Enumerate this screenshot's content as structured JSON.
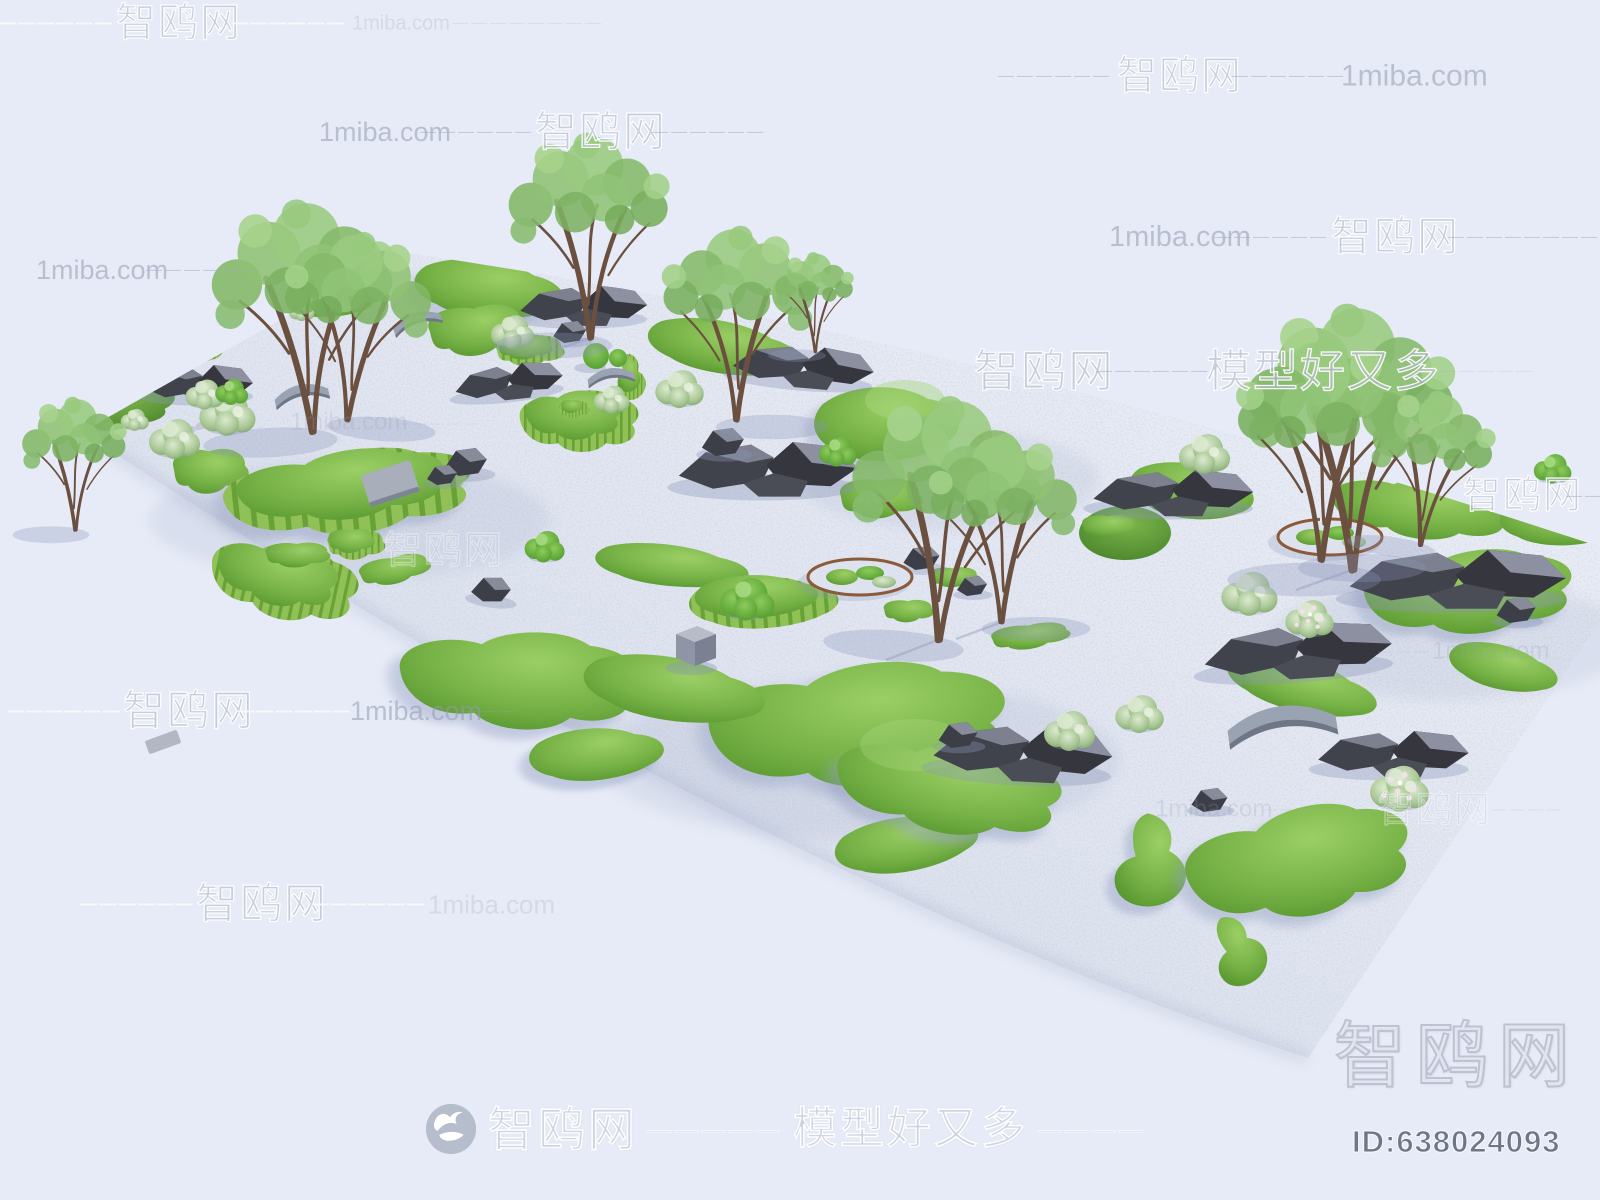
{
  "page": {
    "width": 1600,
    "height": 1200,
    "background": "#e7ebf7",
    "kind": "3D model marketplace product render"
  },
  "image": {
    "description": "Aerial 3D render of a rectangular zen landscape garden: white gravel base with organic green grass mounds, stepped turf terraces, dark rockeries, sage shrubs, slender multi-stem trees, two corten-edged circular planters, small grey arched bridges, a cube seat and topiary balls."
  },
  "palette": {
    "background": "#e7ebf7",
    "gravel": "#dde2ee",
    "gravel_shadow": "#98a3c0",
    "grass_light": "#97cc62",
    "grass_dark": "#4d8a2a",
    "terrace_stripe": "#68a136",
    "rock_dark": "#35363e",
    "rock_light": "#8c90a0",
    "bridge_grey": "#9aa3b2",
    "corten_rim": "#8a5a3a",
    "tree_trunk": "#6b5040",
    "tree_foliage": "#8fc274",
    "watermark_grey": "#929cb0"
  },
  "watermarks": {
    "site_name": "智鸥网",
    "site_url": "1miba.com",
    "slogan": "模型好又多",
    "rows": [
      {
        "y": 24,
        "segments": [
          {
            "t": "——————",
            "kind": "dash",
            "light": true,
            "x": 0,
            "fs": 16
          },
          {
            "t": "智鸥网",
            "kind": "zh",
            "x": 116,
            "fs": 40
          },
          {
            "t": "——————",
            "kind": "dash",
            "light": true,
            "x": 232,
            "fs": 16
          },
          {
            "t": "1miba.com",
            "kind": "url",
            "faint": true,
            "x": 352,
            "fs": 20
          },
          {
            "t": "————————",
            "kind": "dash",
            "faint": true,
            "x": 452,
            "fs": 16
          }
        ]
      },
      {
        "y": 77,
        "segments": [
          {
            "t": "——————",
            "kind": "dash",
            "x": 998,
            "fs": 16
          },
          {
            "t": "智鸥网",
            "kind": "zh",
            "x": 1117,
            "fs": 40
          },
          {
            "t": "——————",
            "kind": "dash",
            "x": 1232,
            "fs": 16
          },
          {
            "t": "1miba.com",
            "kind": "url",
            "x": 1341,
            "fs": 30
          }
        ]
      },
      {
        "y": 133,
        "segments": [
          {
            "t": "1miba.com",
            "kind": "url",
            "x": 319,
            "fs": 27
          },
          {
            "t": "——————",
            "kind": "dash",
            "x": 420,
            "fs": 16
          },
          {
            "t": "智鸥网",
            "kind": "zh",
            "x": 535,
            "fs": 42
          },
          {
            "t": "——————",
            "kind": "dash",
            "x": 652,
            "fs": 16
          }
        ]
      },
      {
        "y": 238,
        "segments": [
          {
            "t": "1miba.com",
            "kind": "url",
            "x": 1109,
            "fs": 29
          },
          {
            "t": "——————",
            "kind": "dash",
            "x": 1215,
            "fs": 16
          },
          {
            "t": "智鸥网",
            "kind": "zh",
            "x": 1331,
            "fs": 41
          },
          {
            "t": "————————",
            "kind": "dash",
            "x": 1448,
            "fs": 16
          }
        ]
      },
      {
        "y": 271,
        "segments": [
          {
            "t": "1miba.com",
            "kind": "url",
            "x": 36,
            "fs": 27
          },
          {
            "t": "——————",
            "kind": "dash",
            "x": 146,
            "fs": 16
          }
        ]
      },
      {
        "y": 372,
        "segments": [
          {
            "t": "智鸥网",
            "kind": "zh",
            "x": 974,
            "fs": 45
          },
          {
            "t": "——————",
            "kind": "dash",
            "x": 1096,
            "fs": 16
          },
          {
            "t": "模型好又多",
            "kind": "zh",
            "x": 1206,
            "fs": 45
          },
          {
            "t": "—————",
            "kind": "dash",
            "faint": true,
            "x": 1440,
            "fs": 16
          }
        ]
      },
      {
        "y": 423,
        "segments": [
          {
            "t": "1miba.com",
            "kind": "url",
            "faint": true,
            "x": 290,
            "fs": 24
          },
          {
            "t": "—————",
            "kind": "dash",
            "faint": true,
            "x": 396,
            "fs": 14
          }
        ]
      },
      {
        "y": 497,
        "segments": [
          {
            "t": "智鸥网",
            "kind": "zh",
            "x": 1463,
            "fs": 38
          },
          {
            "t": "——",
            "kind": "dash",
            "x": 1566,
            "fs": 16
          }
        ]
      },
      {
        "y": 552,
        "segments": [
          {
            "t": "———————",
            "kind": "dash",
            "faint": true,
            "x": 250,
            "fs": 15
          },
          {
            "t": "智鸥网",
            "kind": "zh",
            "faint": true,
            "x": 384,
            "fs": 38
          }
        ]
      },
      {
        "y": 652,
        "segments": [
          {
            "t": "———",
            "kind": "dash",
            "faint": true,
            "x": 1378,
            "fs": 15
          },
          {
            "t": "1miba.com",
            "kind": "url",
            "faint": true,
            "x": 1432,
            "fs": 24
          }
        ]
      },
      {
        "y": 712,
        "segments": [
          {
            "t": "——————",
            "kind": "dash",
            "light": true,
            "x": 8,
            "fs": 16
          },
          {
            "t": "智鸥网",
            "kind": "zh",
            "x": 123,
            "fs": 42
          },
          {
            "t": "——————",
            "kind": "dash",
            "light": true,
            "x": 238,
            "fs": 16
          },
          {
            "t": "1miba.com",
            "kind": "url",
            "x": 350,
            "fs": 27
          },
          {
            "t": "———",
            "kind": "dash",
            "faint": true,
            "x": 460,
            "fs": 16
          }
        ]
      },
      {
        "y": 810,
        "segments": [
          {
            "t": "1miba.com",
            "kind": "url",
            "faint": true,
            "x": 1155,
            "fs": 24
          },
          {
            "t": "———",
            "kind": "dash",
            "faint": true,
            "x": 1262,
            "fs": 15
          },
          {
            "t": "智鸥网",
            "kind": "zh",
            "faint": true,
            "x": 1378,
            "fs": 36
          },
          {
            "t": "————",
            "kind": "dash",
            "faint": true,
            "x": 1492,
            "fs": 15
          }
        ]
      },
      {
        "y": 905,
        "segments": [
          {
            "t": "——————",
            "kind": "dash",
            "light": true,
            "x": 81,
            "fs": 16
          },
          {
            "t": "智鸥网",
            "kind": "zh",
            "x": 196,
            "fs": 42
          },
          {
            "t": "——————",
            "kind": "dash",
            "light": true,
            "x": 312,
            "fs": 16
          },
          {
            "t": "1miba.com",
            "kind": "url",
            "faint": true,
            "x": 428,
            "fs": 26
          }
        ]
      }
    ]
  },
  "footer": {
    "brand": "智鸥网",
    "dashes1": "—————",
    "slogan": "模型好又多",
    "dashes2": "————"
  },
  "corner": {
    "brand": "智鸥网",
    "model_id": "ID:638024093"
  }
}
